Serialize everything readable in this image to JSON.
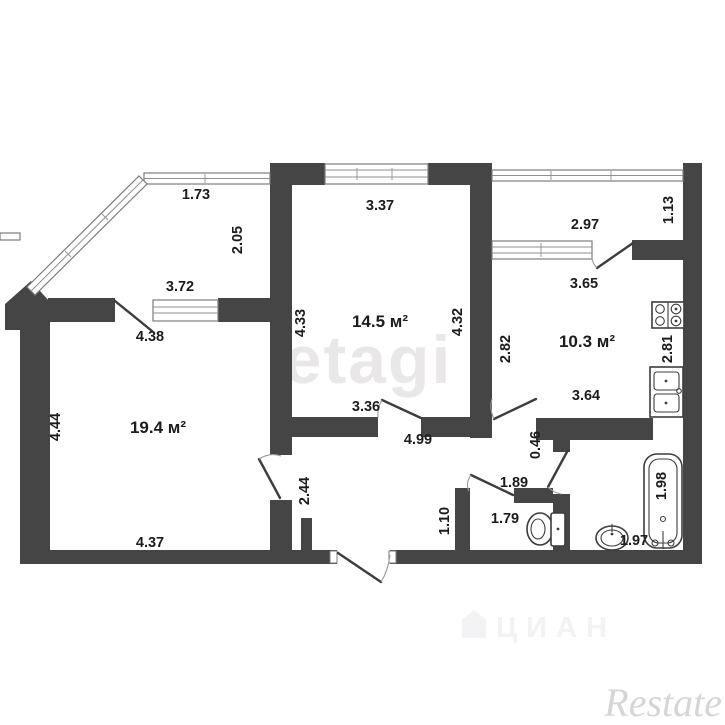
{
  "plan": {
    "type": "apartment-floor-plan",
    "rooms": {
      "living": {
        "area_label": "19.4 м²"
      },
      "bedroom": {
        "area_label": "14.5 м²"
      },
      "kitchen": {
        "area_label": "10.3 м²"
      }
    },
    "dims": {
      "d173": "1.73",
      "d205": "2.05",
      "d372": "3.72",
      "d438": "4.38",
      "d337": "3.37",
      "d433": "4.33",
      "d432": "4.32",
      "d336": "3.36",
      "d297": "2.97",
      "d113": "1.13",
      "d365": "3.65",
      "d282": "2.82",
      "d281": "2.81",
      "d364": "3.64",
      "d444": "4.44",
      "d437": "4.37",
      "d499": "4.99",
      "d244": "2.44",
      "d046": "0.46",
      "d189": "1.89",
      "d179": "1.79",
      "d110": "1.10",
      "d198": "1.98",
      "d197": "1.97"
    },
    "fixtures": [
      "stove-icon",
      "kitchen-sink-icon",
      "toilet-icon",
      "bathtub-icon",
      "washbasin-icon"
    ],
    "watermarks": {
      "center": "etagi",
      "bottom": "ЦИАН",
      "corner": "Restate"
    },
    "colors": {
      "wall": "#454545",
      "window_line": "#8f8f8f",
      "dimension_text": "#1c1c1c",
      "watermark_center": "#e9e7e7",
      "watermark_bottom": "#f3f2f5",
      "watermark_corner": "#d7d6d6"
    }
  }
}
